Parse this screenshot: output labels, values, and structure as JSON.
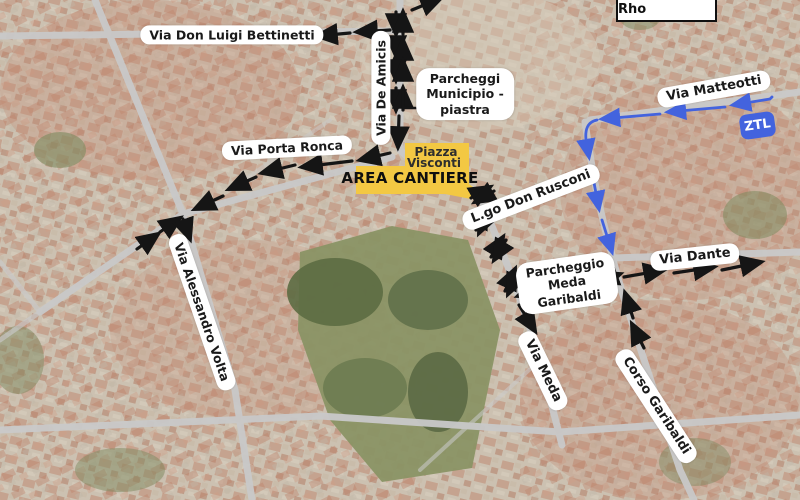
{
  "region": {
    "municipality_box": "Comune di Rho"
  },
  "badges": {
    "ztl": "ZTL"
  },
  "construction_zone": {
    "area_line1": "Piazza",
    "area_line2": "Visconti",
    "banner": "AREA CANTIERE"
  },
  "street_labels": {
    "bettinetti": "Via Don Luigi Bettinetti",
    "de_amicis": "Via De Amicis",
    "parcheggi_municipio": [
      "Parcheggi",
      "Municipio -",
      "piastra"
    ],
    "matteotti": "Via Matteotti",
    "porta_ronca": "Via Porta Ronca",
    "don_rusconi": "L.go Don Rusconi",
    "alessandro_volta": "Via Alessandro Volta",
    "parcheggio_meda_garibaldi": [
      "Parcheggio",
      "Meda",
      "Garibaldi"
    ],
    "dante": "Via Dante",
    "meda": "Via Meda",
    "corso_garibaldi": "Corso Garibaldi"
  },
  "colors": {
    "route_black": "#151515",
    "route_blue": "#4363de",
    "ztl_blue": "#4363de",
    "cantiere_yellow": "#f3c843",
    "label_bg": "#ffffff",
    "label_text": "#1a1a1a"
  }
}
